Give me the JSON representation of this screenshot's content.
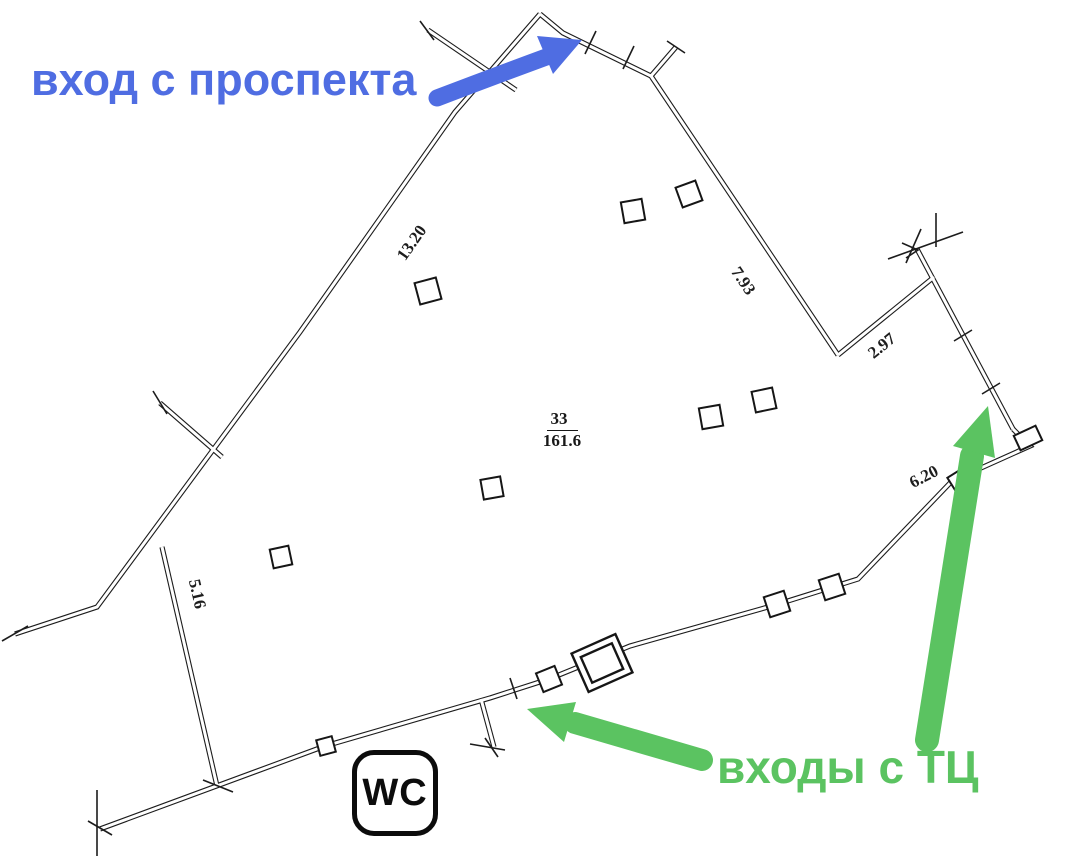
{
  "canvas": {
    "width": 1065,
    "height": 860
  },
  "annotations": {
    "avenue_entrance": {
      "label": "вход с проспекта",
      "color": "#4f6de2"
    },
    "mall_entrances": {
      "label": "входы с ТЦ",
      "color": "#5bc361"
    }
  },
  "plan": {
    "room": {
      "number": "33",
      "area": "161.6"
    },
    "wc_label": "WC",
    "dimensions": {
      "wall_13_20": "13.20",
      "wall_7_93": "7.93",
      "wall_2_97": "2.97",
      "wall_6_20": "6.20",
      "wall_5_16": "5.16"
    },
    "line_color": "#1c1c1c"
  }
}
